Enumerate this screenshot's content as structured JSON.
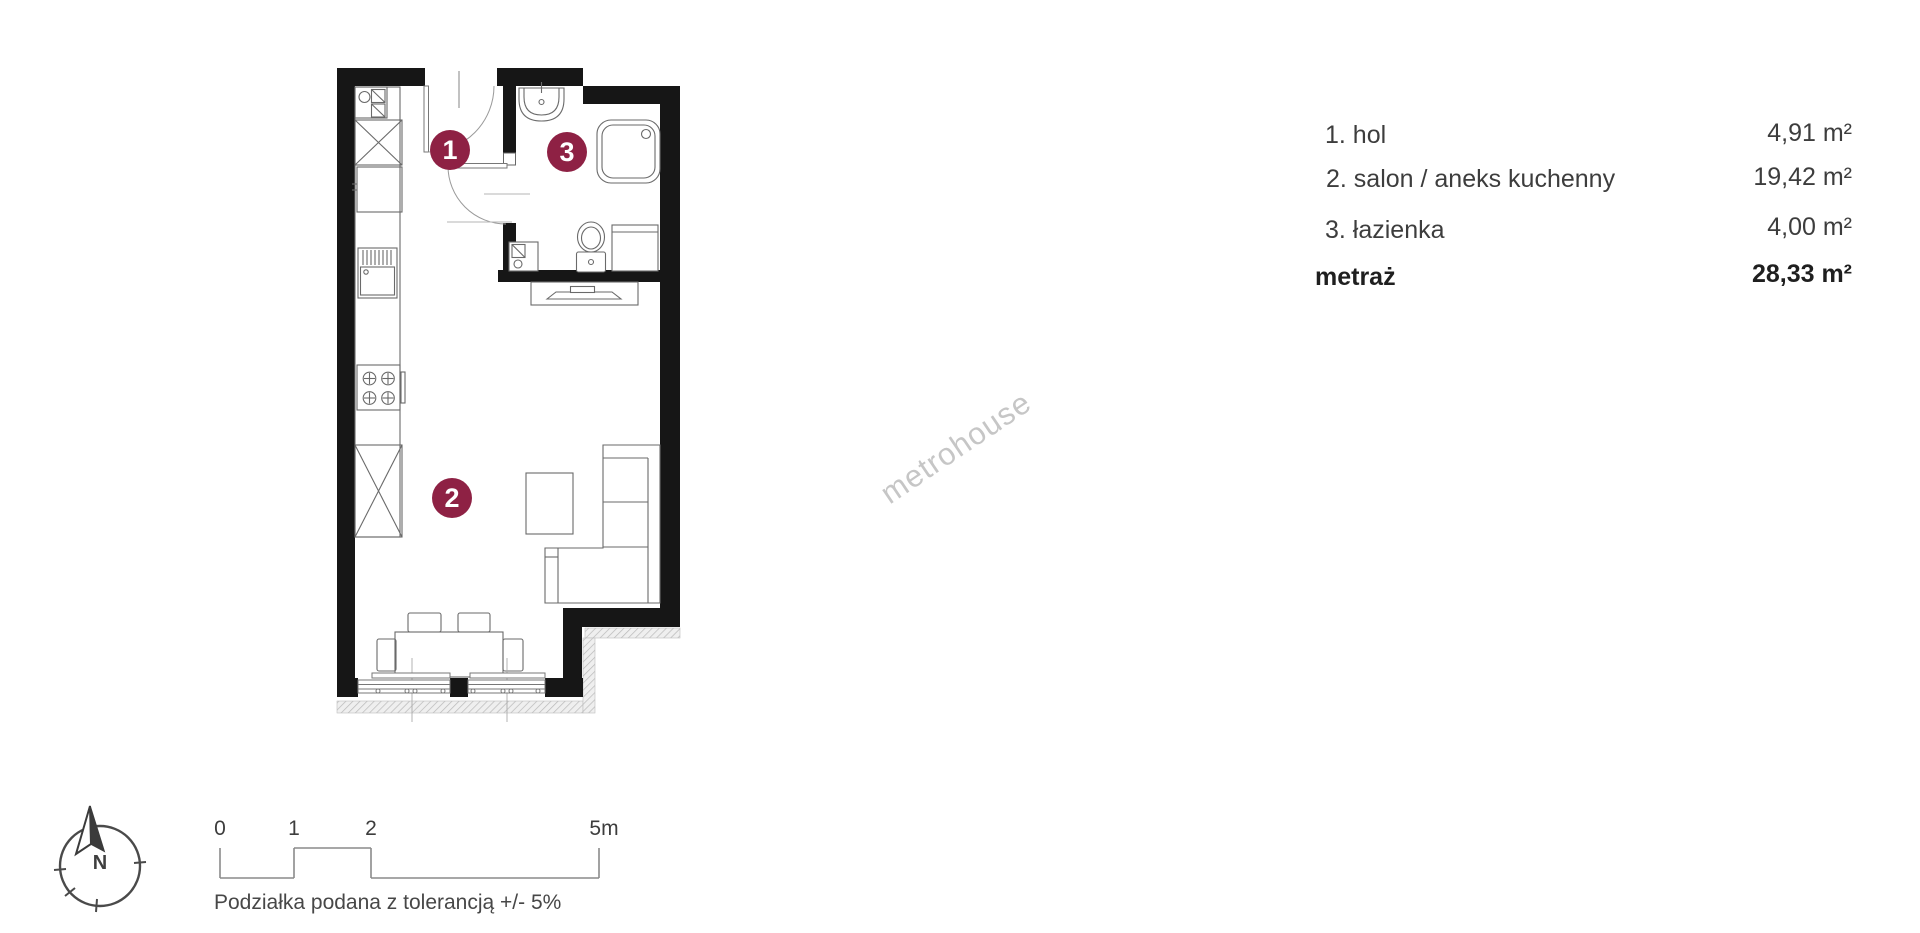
{
  "legend": {
    "rows": [
      {
        "label": "1. hol",
        "value": "4,91 m²"
      },
      {
        "label": "2. salon / aneks kuchenny",
        "value": "19,42 m²"
      },
      {
        "label": "3. łazienka",
        "value": "4,00 m²"
      }
    ],
    "total": {
      "label": "metraż",
      "value": "28,33 m²"
    }
  },
  "plan": {
    "markers": [
      {
        "number": "1"
      },
      {
        "number": "2"
      },
      {
        "number": "3"
      }
    ],
    "marker_color": "#8E2144",
    "wall_color": "#161616"
  },
  "compass": {
    "north_label": "N"
  },
  "scale_bar": {
    "labels": [
      "0",
      "1",
      "2",
      "5m"
    ],
    "caption": "Podziałka podana z tolerancją +/- 5%"
  },
  "watermark": {
    "text": "metrohouse"
  }
}
